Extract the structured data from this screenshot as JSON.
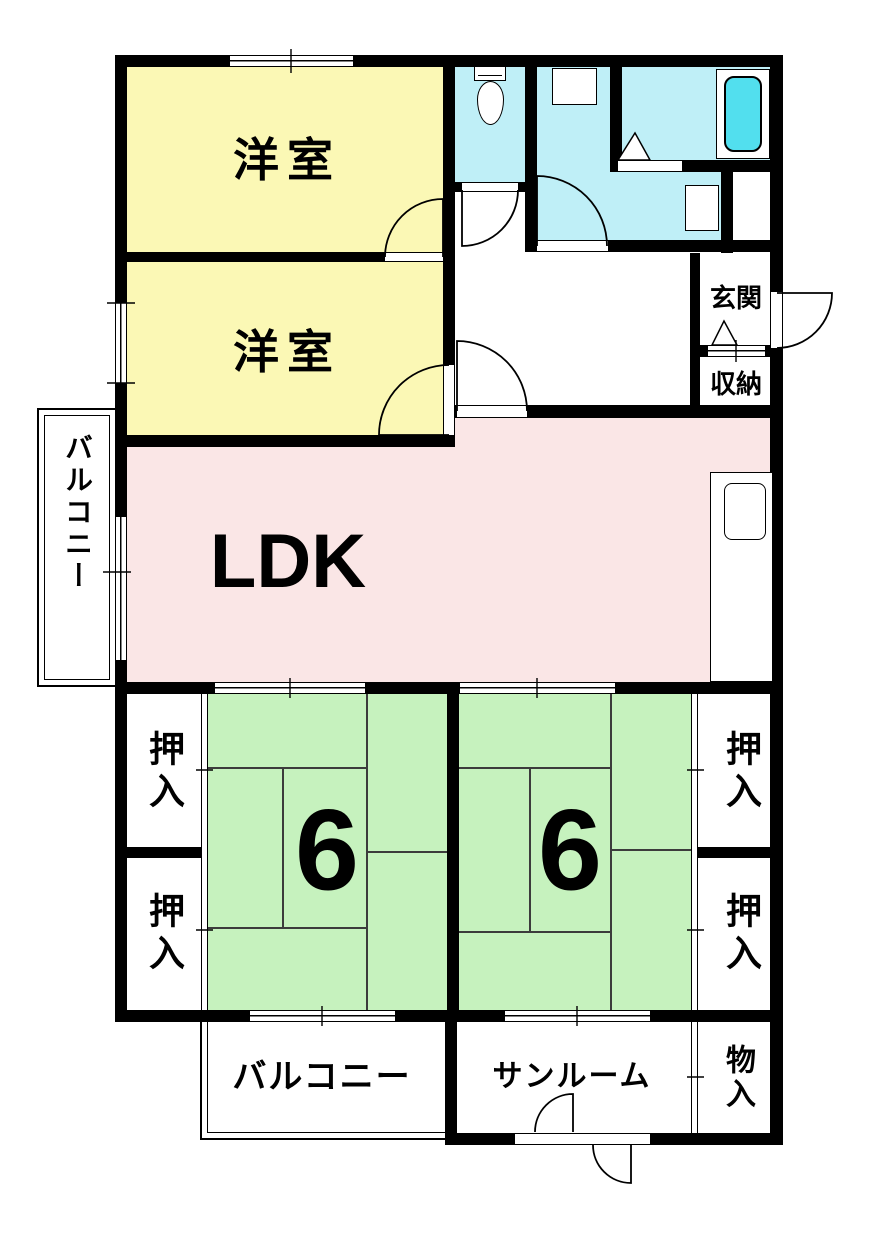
{
  "plan": {
    "type": "floor-plan",
    "colors": {
      "wall": "#000000",
      "western_room": "#fbf8b5",
      "ldk": "#fae6e6",
      "tatami": "#c6f2be",
      "wet_area": "#bfeff7",
      "bathtub_fill": "#52dfee"
    },
    "rooms": {
      "yoshitsu1": {
        "label": "洋室"
      },
      "yoshitsu2": {
        "label": "洋室"
      },
      "ldk": {
        "label": "LDK"
      },
      "tatami1": {
        "label": "6"
      },
      "tatami2": {
        "label": "6"
      },
      "oshiire_tl": {
        "label": "押入"
      },
      "oshiire_bl": {
        "label": "押入"
      },
      "oshiire_tr": {
        "label": "押入"
      },
      "oshiire_br": {
        "label": "押入"
      },
      "genkan": {
        "label": "玄関"
      },
      "shuno": {
        "label": "収納"
      },
      "balcony_left": {
        "label": "バルコニー"
      },
      "balcony_bottom": {
        "label": "バルコニー"
      },
      "sunroom": {
        "label": "サンルーム"
      },
      "monoire": {
        "label": "物入"
      }
    },
    "fixtures": {
      "toilet": "toilet",
      "washing_machine": "washing-machine-pan",
      "bathtub": "bathtub",
      "washbasin": "washbasin",
      "kitchen": "kitchen-counter-with-sink"
    }
  }
}
